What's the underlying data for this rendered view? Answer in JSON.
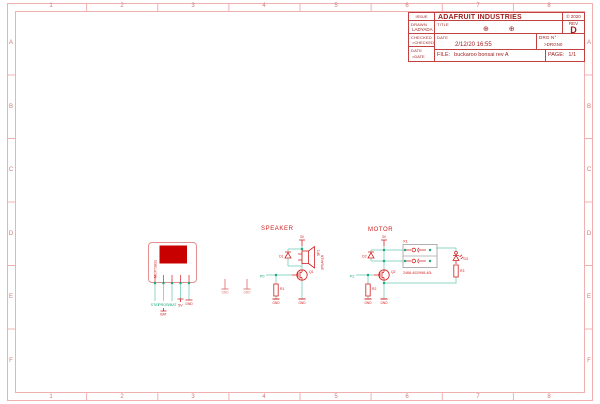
{
  "sheet": {
    "columns": [
      "1",
      "2",
      "3",
      "4",
      "5",
      "6",
      "7",
      "8"
    ],
    "rows": [
      "A",
      "B",
      "C",
      "D",
      "E",
      "F"
    ],
    "colors": {
      "frame_pink": "#f0b0b0",
      "title_red": "#9e1b1b",
      "symbol_red": "#d42020",
      "wire_teal": "#8fd6c6",
      "net_green": "#1faa7f",
      "board_fill": "#c80000",
      "connector_gray": "#a8a8a8"
    }
  },
  "title_block": {
    "issue_label": "ISSUE",
    "drawn_label": "DRAWN",
    "drawn_value": "LADYADA",
    "checked_label": "CHECKED",
    "checked_value": ">CHECKED",
    "date_left_label": "DATE",
    "date_left_value": ">DATE",
    "company": "ADAFRUIT INDUSTRIES",
    "copyright": "© 2020",
    "title_label": "TITLE",
    "title_value": "⊕ ⊕",
    "rev_label": "REV",
    "rev_value": "D",
    "date_label": "DATE",
    "date_value": "2/12/20 16:55",
    "drg_label": "DRG N°",
    "drg_value": ">DRGN0",
    "file_label": "FILE:",
    "file_value": "buckaroo bonsai rev A",
    "page_label": "PAGE:",
    "page_value": "1/1"
  },
  "schematic": {
    "charger": {
      "value": "MCP73831",
      "pin_nets": [
        "STAT",
        "PROG",
        "VBAT",
        "5V",
        "GND"
      ],
      "pin2_flag": "BAT"
    },
    "mid_gnd": [
      "GND",
      "GND"
    ],
    "speaker": {
      "title": "SPEAKER",
      "power_net": "3V",
      "diode_ref": "D1",
      "ref": "SP1",
      "value": "SPEAKER",
      "mosfet_ref": "Q1",
      "gate_net": "P0",
      "res_ref": "R1",
      "gnd": [
        "GND",
        "GND"
      ]
    },
    "motor": {
      "title": "MOTOR",
      "power_net": "3V",
      "diode_ref": "D2",
      "conn_ref": "X1",
      "conn_value": "2468-402/998-40L",
      "led_ref": "D3",
      "res2_ref": "R3",
      "mosfet_ref": "Q2",
      "gate_net": "P2",
      "res_ref": "R2",
      "gnd": [
        "GND",
        "GND"
      ]
    }
  }
}
